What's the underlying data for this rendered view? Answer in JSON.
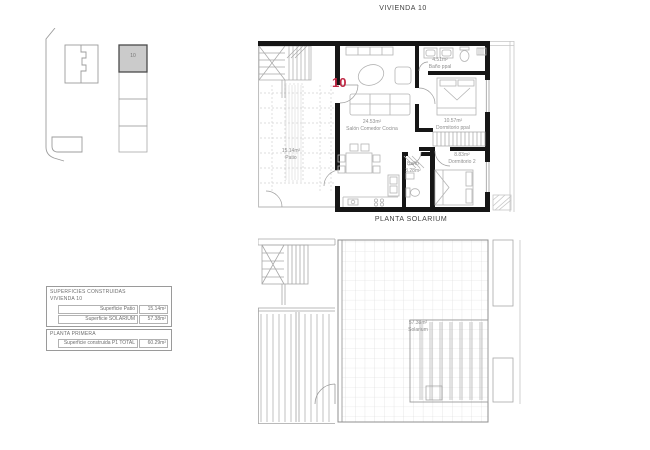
{
  "page": {
    "title": "VIVIENDA 10",
    "solarium_plan_title": "PLANTA SOLARIUM"
  },
  "keyplan": {
    "unit_label": "10"
  },
  "floorplan": {
    "unit_number": "10",
    "living": {
      "area": "24.53m²",
      "name": "Salón Comedor Cocina"
    },
    "patio": {
      "area": "15.14m²",
      "name": "Patio"
    },
    "bath_main": {
      "area": "4.51m²",
      "name": "Baño ppal"
    },
    "bedroom_main": {
      "area": "10.57m²",
      "name": "Dormitorio ppal"
    },
    "bedroom_2": {
      "area": "8.83m²",
      "name": "Dormitorio 2"
    },
    "bath_2": {
      "name": "Baño",
      "area": "3.28m²"
    }
  },
  "solarium": {
    "area": "57.38m²",
    "name": "Solarium"
  },
  "areas_table": {
    "header_line1": "SUPERFICIES CONSTRUIDAS",
    "header_line2": "VIVIENDA 10",
    "rows": [
      {
        "label": "Superficie Patio",
        "value": "15.14m²"
      },
      {
        "label": "Superficie SOLARIUM",
        "value": "57.38m²"
      }
    ],
    "section_header": "PLANTA PRIMERA",
    "total": {
      "label": "Superficie construida P1 TOTAL",
      "value": "60.29m²"
    }
  },
  "colors": {
    "accent": "#bf2743",
    "wall": "#161616",
    "highlight_fill": "#cbcbcb"
  }
}
